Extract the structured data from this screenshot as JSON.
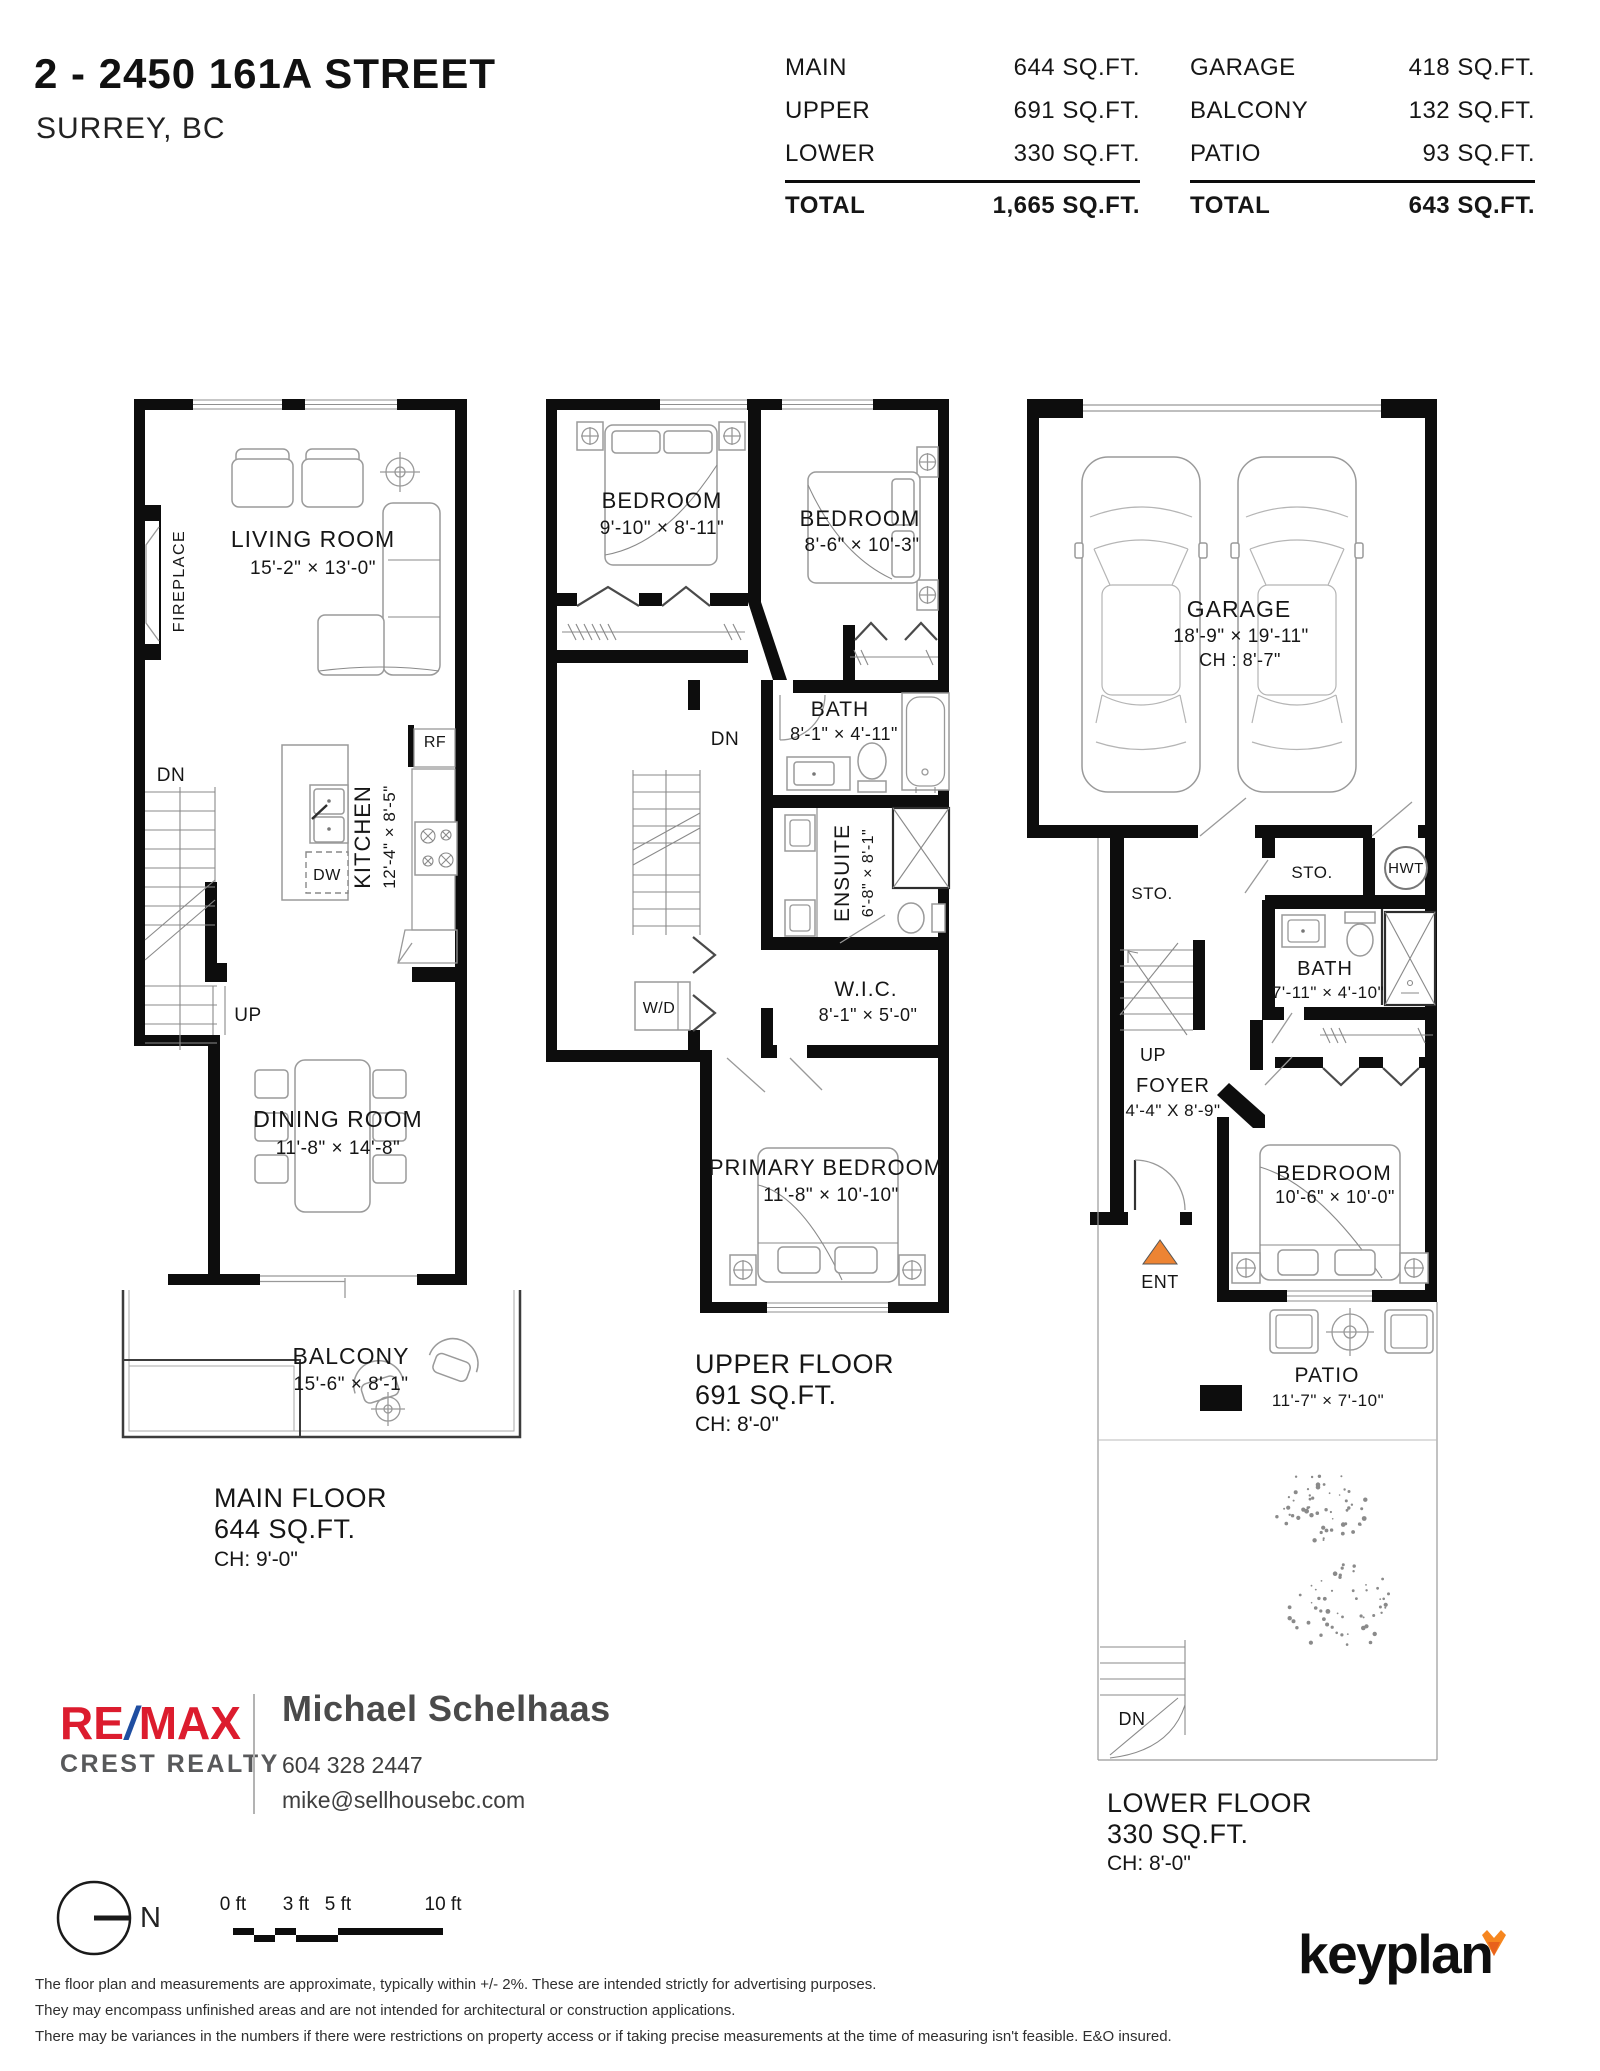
{
  "header": {
    "address": "2 - 2450 161A STREET",
    "city": "SURREY, BC",
    "table": {
      "rows_left": [
        {
          "label": "MAIN",
          "value": "644 SQ.FT."
        },
        {
          "label": "UPPER",
          "value": "691 SQ.FT."
        },
        {
          "label": "LOWER",
          "value": "330 SQ.FT."
        }
      ],
      "total_left": {
        "label": "TOTAL",
        "value": "1,665 SQ.FT."
      },
      "rows_right": [
        {
          "label": "GARAGE",
          "value": "418 SQ.FT."
        },
        {
          "label": "BALCONY",
          "value": "132 SQ.FT."
        },
        {
          "label": "PATIO",
          "value": "93 SQ.FT."
        }
      ],
      "total_right": {
        "label": "TOTAL",
        "value": "643 SQ.FT."
      }
    }
  },
  "main_floor": {
    "fireplace": "FIREPLACE",
    "living": {
      "name": "LIVING ROOM",
      "dims": "15'-2\" × 13'-0\""
    },
    "kitchen": {
      "name": "KITCHEN",
      "dims": "12'-4\" × 8'-5\""
    },
    "dining": {
      "name": "DINING ROOM",
      "dims": "11'-8\" × 14'-8\""
    },
    "balcony": {
      "name": "BALCONY",
      "dims": "15'-6\" × 8'-1\""
    },
    "dn": "DN",
    "up": "UP",
    "rf": "RF",
    "dw": "DW",
    "caption": {
      "title": "MAIN FLOOR",
      "area": "644 SQ.FT.",
      "ch": "CH: 9'-0\""
    }
  },
  "upper_floor": {
    "bedroom1": {
      "name": "BEDROOM",
      "dims": "9'-10\" × 8'-11\""
    },
    "bedroom2": {
      "name": "BEDROOM",
      "dims": "8'-6\" × 10'-3\""
    },
    "bath": {
      "name": "BATH",
      "dims": "8'-1\" × 4'-11\""
    },
    "ensuite": {
      "name": "ENSUITE",
      "dims": "6'-8\" × 8'-1\""
    },
    "wic": {
      "name": "W.I.C.",
      "dims": "8'-1\" × 5'-0\""
    },
    "primary": {
      "name": "PRIMARY BEDROOM",
      "dims": "11'-8\" × 10'-10\""
    },
    "dn": "DN",
    "wd": "W/D",
    "caption": {
      "title": "UPPER FLOOR",
      "area": "691 SQ.FT.",
      "ch": "CH: 8'-0\""
    }
  },
  "lower_floor": {
    "garage": {
      "name": "GARAGE",
      "dims": "18'-9\" × 19'-11\"",
      "ch": "CH : 8'-7\""
    },
    "sto1": "STO.",
    "sto2": "STO.",
    "hwt": "HWT",
    "bath": {
      "name": "BATH",
      "dims": "7'-11\" × 4'-10\""
    },
    "foyer": {
      "name": "FOYER",
      "dims": "4'-4\" X 8'-9\""
    },
    "bedroom": {
      "name": "BEDROOM",
      "dims": "10'-6\" × 10'-0\""
    },
    "patio": {
      "name": "PATIO",
      "dims": "11'-7\" × 7'-10\""
    },
    "up": "UP",
    "dn": "DN",
    "ent": "ENT",
    "caption": {
      "title": "LOWER FLOOR",
      "area": "330 SQ.FT.",
      "ch": "CH: 8'-0\""
    }
  },
  "footer": {
    "brokerage": {
      "re": "RE",
      "slash": "/",
      "max": "MAX",
      "line2": "CREST REALTY"
    },
    "agent": {
      "name": "Michael Schelhaas",
      "phone": "604 328 2447",
      "email": "mike@sellhousebc.com"
    },
    "compass_n": "N",
    "scale": {
      "t0": "0 ft",
      "t3": "3 ft",
      "t5": "5 ft",
      "t10": "10 ft"
    },
    "disclaimer": [
      "The floor plan and measurements are approximate, typically within +/- 2%. These are intended strictly for advertising purposes.",
      "They may encompass unfinished areas and are not intended for architectural or construction applications.",
      "There may be variances in the numbers if there were restrictions on property access or if taking precise measurements at the time of measuring isn't feasible. E&O insured."
    ],
    "logo": "keyplan"
  },
  "colors": {
    "accent_red": "#DC1C2E",
    "accent_blue": "#1F4EA1",
    "fox_orange": "#F6861F",
    "ent_orange": "#ED8433"
  }
}
